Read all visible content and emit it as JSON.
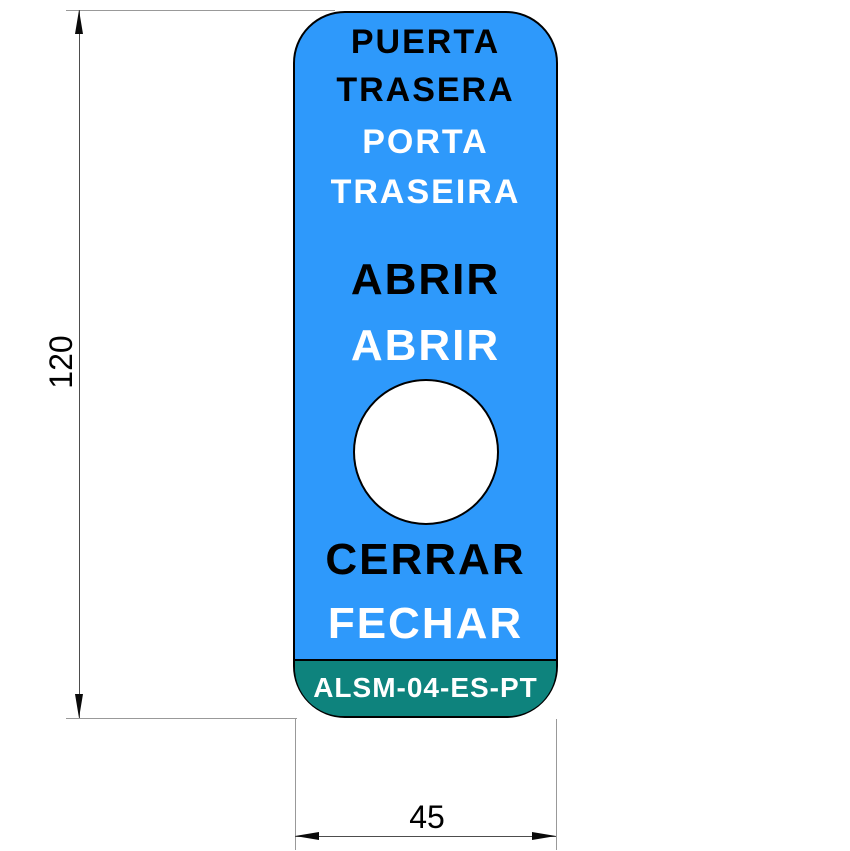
{
  "drawing": {
    "plate": {
      "text_lines": [
        {
          "text": "PUERTA",
          "color": "#000000",
          "language": "es"
        },
        {
          "text": "TRASERA",
          "color": "#000000",
          "language": "es"
        },
        {
          "text": "PORTA",
          "color": "#ffffff",
          "language": "pt"
        },
        {
          "text": "TRASEIRA",
          "color": "#ffffff",
          "language": "pt"
        },
        {
          "text": "ABRIR",
          "color": "#000000",
          "language": "es"
        },
        {
          "text": "ABRIR",
          "color": "#ffffff",
          "language": "pt"
        },
        {
          "text": "CERRAR",
          "color": "#000000",
          "language": "es"
        },
        {
          "text": "FECHAR",
          "color": "#ffffff",
          "language": "pt"
        }
      ],
      "part_code": "ALSM-04-ES-PT",
      "colors": {
        "plate_blue": "#2E99FB",
        "band_teal": "#0E837D",
        "outline": "#000000",
        "hole_fill": "#ffffff"
      }
    },
    "dimensions": {
      "height_label": "120",
      "width_label": "45"
    }
  }
}
